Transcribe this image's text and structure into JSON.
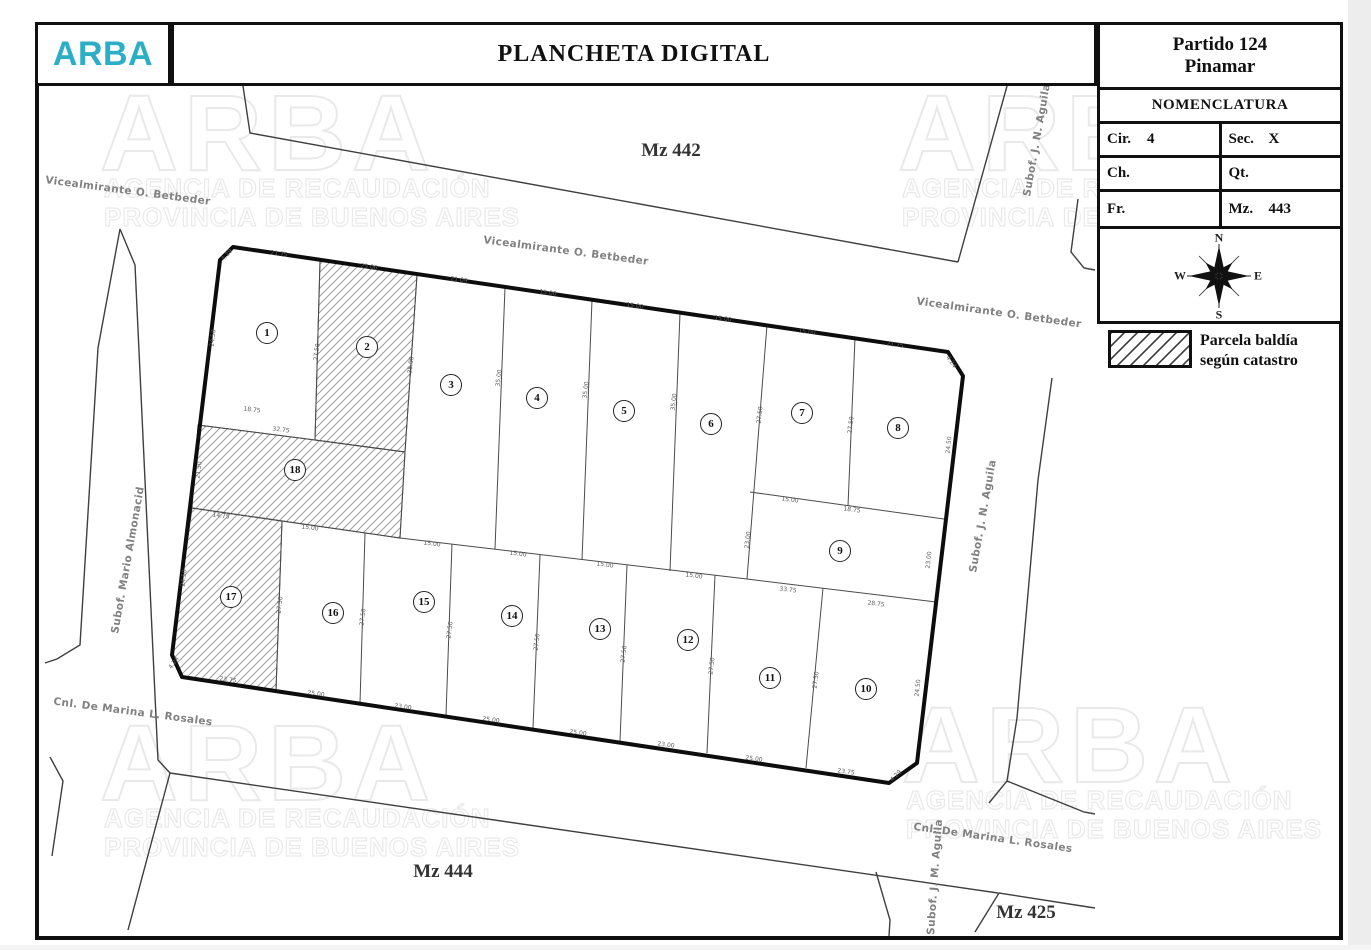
{
  "header": {
    "logo": "ARBA",
    "logo_color": "#2BAEC6",
    "title": "PLANCHETA DIGITAL"
  },
  "panel": {
    "partido_line1": "Partido 124",
    "partido_line2": "Pinamar",
    "nomenclatura_title": "NOMENCLATURA",
    "fields": [
      {
        "label": "Cir.",
        "value": "4"
      },
      {
        "label": "Sec.",
        "value": "X"
      },
      {
        "label": "Ch.",
        "value": ""
      },
      {
        "label": "Qt.",
        "value": ""
      },
      {
        "label": "Fr.",
        "value": ""
      },
      {
        "label": "Mz.",
        "value": "443"
      }
    ],
    "compass": {
      "n": "N",
      "s": "S",
      "e": "E",
      "w": "W"
    },
    "legend": {
      "line1": "Parcela baldía",
      "line2": "según catastro"
    }
  },
  "map": {
    "mz_labels": [
      {
        "text": "Mz 442",
        "x": 671,
        "y": 151
      },
      {
        "text": "Mz 444",
        "x": 443,
        "y": 872
      },
      {
        "text": "Mz 425",
        "x": 1026,
        "y": 913
      }
    ],
    "street_labels": [
      {
        "text": "Vicealmirante O. Betbeder",
        "x": 128,
        "y": 191,
        "angle": 7.5
      },
      {
        "text": "Vicealmirante O. Betbeder",
        "x": 566,
        "y": 251,
        "angle": 7.5
      },
      {
        "text": "Vicealmirante O. Betbeder",
        "x": 999,
        "y": 313,
        "angle": 8
      },
      {
        "text": "Subof. J. N. Aguila",
        "x": 1037,
        "y": 140,
        "angle": -80
      },
      {
        "text": "Subof. J. N. Aguila",
        "x": 983,
        "y": 516,
        "angle": -80
      },
      {
        "text": "Subof. Mario Almonacid",
        "x": 128,
        "y": 560,
        "angle": -80
      },
      {
        "text": "Cnl. De Marina L. Rosales",
        "x": 133,
        "y": 712,
        "angle": 7.5
      },
      {
        "text": "Cnl. De Marina L. Rosales",
        "x": 993,
        "y": 838,
        "angle": 8
      },
      {
        "text": "Subof. J. M. Aguila",
        "x": 935,
        "y": 877,
        "angle": -86
      }
    ],
    "parcels": [
      {
        "n": "1",
        "x": 267,
        "y": 333,
        "hatched": false
      },
      {
        "n": "2",
        "x": 367,
        "y": 347,
        "hatched": true
      },
      {
        "n": "3",
        "x": 451,
        "y": 385,
        "hatched": false
      },
      {
        "n": "4",
        "x": 537,
        "y": 398,
        "hatched": false
      },
      {
        "n": "5",
        "x": 624,
        "y": 411,
        "hatched": false
      },
      {
        "n": "6",
        "x": 711,
        "y": 424,
        "hatched": false
      },
      {
        "n": "7",
        "x": 802,
        "y": 413,
        "hatched": false
      },
      {
        "n": "8",
        "x": 898,
        "y": 428,
        "hatched": false
      },
      {
        "n": "9",
        "x": 840,
        "y": 551,
        "hatched": false
      },
      {
        "n": "10",
        "x": 866,
        "y": 689,
        "hatched": false
      },
      {
        "n": "11",
        "x": 770,
        "y": 678,
        "hatched": false
      },
      {
        "n": "12",
        "x": 688,
        "y": 640,
        "hatched": false
      },
      {
        "n": "13",
        "x": 600,
        "y": 629,
        "hatched": false
      },
      {
        "n": "14",
        "x": 512,
        "y": 616,
        "hatched": false
      },
      {
        "n": "15",
        "x": 424,
        "y": 602,
        "hatched": false
      },
      {
        "n": "16",
        "x": 333,
        "y": 613,
        "hatched": false
      },
      {
        "n": "17",
        "x": 231,
        "y": 597,
        "hatched": true
      },
      {
        "n": "18",
        "x": 295,
        "y": 470,
        "hatched": true
      }
    ],
    "dimensions": [
      {
        "t": "4.29",
        "x": 227,
        "y": 255,
        "a": -48
      },
      {
        "t": "21.75",
        "x": 279,
        "y": 254,
        "a": 8
      },
      {
        "t": "23.06",
        "x": 369,
        "y": 267,
        "a": 8
      },
      {
        "t": "21.09",
        "x": 459,
        "y": 280,
        "a": 8
      },
      {
        "t": "15.00",
        "x": 548,
        "y": 293,
        "a": 8
      },
      {
        "t": "15.00",
        "x": 635,
        "y": 306,
        "a": 8
      },
      {
        "t": "15.00",
        "x": 723,
        "y": 319,
        "a": 8
      },
      {
        "t": "15.00",
        "x": 807,
        "y": 332,
        "a": 8
      },
      {
        "t": "21.75",
        "x": 895,
        "y": 345,
        "a": 8
      },
      {
        "t": "4.24",
        "x": 951,
        "y": 362,
        "a": 55
      },
      {
        "t": "24.50",
        "x": 213,
        "y": 338,
        "a": -83
      },
      {
        "t": "21.50",
        "x": 199,
        "y": 470,
        "a": -83
      },
      {
        "t": "24.50",
        "x": 184,
        "y": 578,
        "a": -83
      },
      {
        "t": "4.24",
        "x": 174,
        "y": 663,
        "a": -55
      },
      {
        "t": "23.75",
        "x": 228,
        "y": 680,
        "a": 8
      },
      {
        "t": "25.00",
        "x": 316,
        "y": 694,
        "a": 8
      },
      {
        "t": "23.00",
        "x": 403,
        "y": 707,
        "a": 8
      },
      {
        "t": "25.00",
        "x": 491,
        "y": 720,
        "a": 8
      },
      {
        "t": "25.00",
        "x": 578,
        "y": 733,
        "a": 8
      },
      {
        "t": "23.00",
        "x": 666,
        "y": 745,
        "a": 8
      },
      {
        "t": "25.00",
        "x": 754,
        "y": 759,
        "a": 8
      },
      {
        "t": "23.75",
        "x": 846,
        "y": 772,
        "a": 8
      },
      {
        "t": "4.29",
        "x": 896,
        "y": 776,
        "a": -45
      },
      {
        "t": "24.50",
        "x": 949,
        "y": 445,
        "a": -84
      },
      {
        "t": "23.00",
        "x": 929,
        "y": 560,
        "a": -84
      },
      {
        "t": "24.50",
        "x": 918,
        "y": 688,
        "a": -84
      },
      {
        "t": "18.75",
        "x": 252,
        "y": 410,
        "a": 7
      },
      {
        "t": "32.75",
        "x": 281,
        "y": 430,
        "a": 7
      },
      {
        "t": "14.75",
        "x": 221,
        "y": 516,
        "a": 7
      },
      {
        "t": "15.00",
        "x": 310,
        "y": 528,
        "a": 7
      },
      {
        "t": "15.00",
        "x": 432,
        "y": 544,
        "a": 7
      },
      {
        "t": "15.00",
        "x": 518,
        "y": 554,
        "a": 7
      },
      {
        "t": "15.00",
        "x": 605,
        "y": 565,
        "a": 7
      },
      {
        "t": "15.00",
        "x": 694,
        "y": 576,
        "a": 7
      },
      {
        "t": "33.75",
        "x": 788,
        "y": 590,
        "a": 7
      },
      {
        "t": "28.75",
        "x": 876,
        "y": 604,
        "a": 7
      },
      {
        "t": "15.00",
        "x": 790,
        "y": 500,
        "a": 8
      },
      {
        "t": "18.75",
        "x": 852,
        "y": 510,
        "a": 8
      },
      {
        "t": "27.50",
        "x": 317,
        "y": 352,
        "a": -83
      },
      {
        "t": "35.00",
        "x": 411,
        "y": 365,
        "a": -83
      },
      {
        "t": "35.00",
        "x": 499,
        "y": 378,
        "a": -83
      },
      {
        "t": "35.00",
        "x": 586,
        "y": 390,
        "a": -83
      },
      {
        "t": "35.00",
        "x": 674,
        "y": 402,
        "a": -83
      },
      {
        "t": "27.50",
        "x": 760,
        "y": 415,
        "a": -83
      },
      {
        "t": "27.50",
        "x": 851,
        "y": 425,
        "a": -83
      },
      {
        "t": "23.00",
        "x": 748,
        "y": 540,
        "a": -83
      },
      {
        "t": "27.50",
        "x": 280,
        "y": 605,
        "a": -83
      },
      {
        "t": "27.50",
        "x": 363,
        "y": 617,
        "a": -83
      },
      {
        "t": "27.50",
        "x": 450,
        "y": 630,
        "a": -83
      },
      {
        "t": "27.50",
        "x": 537,
        "y": 642,
        "a": -83
      },
      {
        "t": "27.50",
        "x": 624,
        "y": 654,
        "a": -83
      },
      {
        "t": "27.50",
        "x": 712,
        "y": 666,
        "a": -83
      },
      {
        "t": "27.50",
        "x": 816,
        "y": 680,
        "a": -83
      }
    ],
    "watermark": {
      "brand": "ARBA",
      "line1": "AGENCIA DE RECAUDACIÓN",
      "line2": "PROVINCIA DE BUENOS AIRES"
    },
    "watermark_positions": [
      {
        "x": 100,
        "y": 70,
        "big": false
      },
      {
        "x": 898,
        "y": 70,
        "big": false
      },
      {
        "x": 490,
        "y": 368,
        "big": true
      },
      {
        "x": 100,
        "y": 700,
        "big": false
      },
      {
        "x": 902,
        "y": 682,
        "big": false
      }
    ]
  }
}
